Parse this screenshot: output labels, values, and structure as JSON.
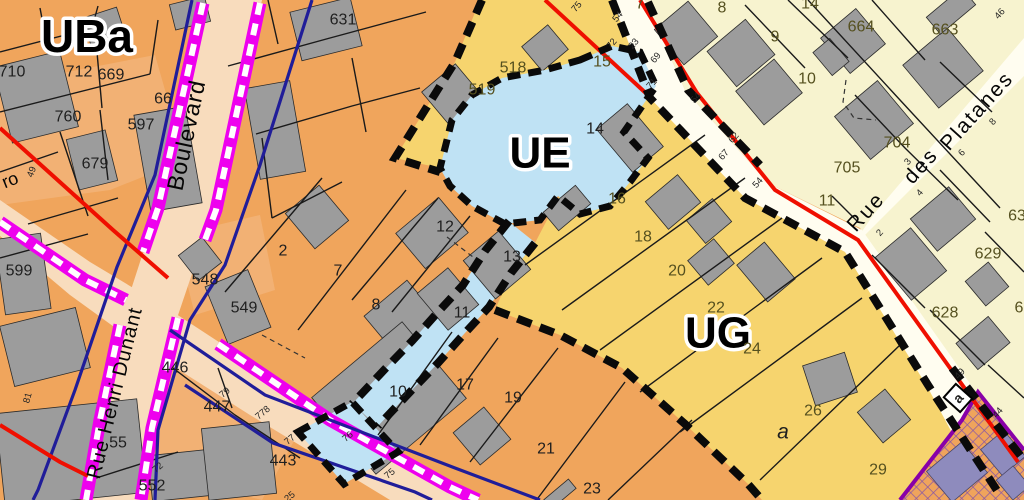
{
  "map": {
    "title": "zoning-plan-extract",
    "zones": {
      "uba": {
        "label": "UBa",
        "color": "#f0a55c"
      },
      "ue": {
        "label": "UE",
        "color": "#bfe2f4"
      },
      "ug": {
        "label": "UG",
        "color": "#f6d46e"
      },
      "cream_zone_color": "#f7f3cf",
      "street_color": "#f8dcbd",
      "white_street_color": "#fffdf0",
      "building_color": "#9c9c9c",
      "hatch_building_color": "#8e8bbd"
    },
    "line_colors": {
      "magenta": "#ee00ee",
      "navy": "#201d99",
      "red": "#ef0f00",
      "purple": "#8800a8",
      "boundary_black": "#0a0a0a",
      "parcel_line": "#1a1a1a"
    },
    "zone_labels": {
      "uba": {
        "text": "UBa"
      },
      "ue": {
        "text": "UE"
      },
      "ug": {
        "text": "UG"
      }
    },
    "street_labels": [
      {
        "t": "Boulevard",
        "x": 186,
        "y": 135,
        "r": -78,
        "s": 23,
        "ls": 1
      },
      {
        "t": "Rue Henri Dunant",
        "x": 115,
        "y": 393,
        "r": -76,
        "s": 20,
        "ls": 1
      },
      {
        "t": "ro",
        "x": 10,
        "y": 180,
        "r": -22,
        "s": 18,
        "ls": 0
      },
      {
        "t": "Rue",
        "x": 866,
        "y": 212,
        "r": -48,
        "s": 21,
        "ls": 2
      },
      {
        "t": "des",
        "x": 921,
        "y": 166,
        "r": -48,
        "s": 21,
        "ls": 2
      },
      {
        "t": "Platanes",
        "x": 977,
        "y": 111,
        "r": -48,
        "s": 21,
        "ls": 2
      }
    ],
    "parcel_labels": [
      {
        "t": "631",
        "x": 343,
        "y": 20
      },
      {
        "t": "710",
        "x": 12,
        "y": 72
      },
      {
        "t": "712",
        "x": 79,
        "y": 72
      },
      {
        "t": "669",
        "x": 111,
        "y": 75
      },
      {
        "t": "66",
        "x": 163,
        "y": 99
      },
      {
        "t": "760",
        "x": 68,
        "y": 117
      },
      {
        "t": "597",
        "x": 141,
        "y": 125
      },
      {
        "t": "679",
        "x": 95,
        "y": 164
      },
      {
        "t": "599",
        "x": 19,
        "y": 271
      },
      {
        "t": "548",
        "x": 205,
        "y": 280
      },
      {
        "t": "549",
        "x": 244,
        "y": 308
      },
      {
        "t": "446",
        "x": 175,
        "y": 368
      },
      {
        "t": "447",
        "x": 217,
        "y": 407
      },
      {
        "t": "443",
        "x": 283,
        "y": 461
      },
      {
        "t": "552",
        "x": 152,
        "y": 486
      },
      {
        "t": "55",
        "x": 118,
        "y": 443
      },
      {
        "t": "2",
        "x": 283,
        "y": 251
      },
      {
        "t": "7",
        "x": 338,
        "y": 271
      },
      {
        "t": "8",
        "x": 376,
        "y": 305
      },
      {
        "t": "12",
        "x": 445,
        "y": 227
      },
      {
        "t": "13",
        "x": 512,
        "y": 257
      },
      {
        "t": "11",
        "x": 462,
        "y": 313
      },
      {
        "t": "10",
        "x": 398,
        "y": 392
      },
      {
        "t": "17",
        "x": 465,
        "y": 385
      },
      {
        "t": "19",
        "x": 513,
        "y": 398
      },
      {
        "t": "21",
        "x": 546,
        "y": 449
      },
      {
        "t": "23",
        "x": 592,
        "y": 489
      },
      {
        "t": "518",
        "x": 513,
        "y": 68,
        "c": "olive"
      },
      {
        "t": "519",
        "x": 482,
        "y": 90,
        "c": "olive"
      },
      {
        "t": "15",
        "x": 602,
        "y": 62,
        "c": "olive"
      },
      {
        "t": "14",
        "x": 595,
        "y": 129
      },
      {
        "t": "16",
        "x": 617,
        "y": 199,
        "c": "olive"
      },
      {
        "t": "18",
        "x": 643,
        "y": 237,
        "c": "olive"
      },
      {
        "t": "20",
        "x": 677,
        "y": 271,
        "c": "olive"
      },
      {
        "t": "22",
        "x": 716,
        "y": 308,
        "c": "olive"
      },
      {
        "t": "24",
        "x": 752,
        "y": 349,
        "c": "olive"
      },
      {
        "t": "26",
        "x": 813,
        "y": 411,
        "c": "olive"
      },
      {
        "t": "29",
        "x": 878,
        "y": 470,
        "c": "olive"
      },
      {
        "t": "a",
        "x": 783,
        "y": 432,
        "c": "italic"
      },
      {
        "t": "7",
        "x": 640,
        "y": 4,
        "c": "olive"
      },
      {
        "t": "8",
        "x": 722,
        "y": 8,
        "c": "olive"
      },
      {
        "t": "9",
        "x": 775,
        "y": 37,
        "c": "olive"
      },
      {
        "t": "10",
        "x": 807,
        "y": 79,
        "c": "olive"
      },
      {
        "t": "14",
        "x": 810,
        "y": 4,
        "c": "olive"
      },
      {
        "t": "664",
        "x": 861,
        "y": 27,
        "c": "olive"
      },
      {
        "t": "663",
        "x": 945,
        "y": 30,
        "c": "olive"
      },
      {
        "t": "704",
        "x": 897,
        "y": 143,
        "c": "olive"
      },
      {
        "t": "705",
        "x": 847,
        "y": 168,
        "c": "olive"
      },
      {
        "t": "11",
        "x": 827,
        "y": 201,
        "c": "olive"
      },
      {
        "t": "629",
        "x": 988,
        "y": 254,
        "c": "olive"
      },
      {
        "t": "628",
        "x": 945,
        "y": 313,
        "c": "olive"
      },
      {
        "t": "63",
        "x": 1017,
        "y": 216,
        "c": "olive"
      },
      {
        "t": "6",
        "x": 1019,
        "y": 308,
        "c": "olive"
      }
    ],
    "tick_labels": [
      {
        "t": "75",
        "x": 577,
        "y": 7,
        "r": -50
      },
      {
        "t": "54",
        "x": 618,
        "y": 17,
        "r": -50
      },
      {
        "t": "72",
        "x": 612,
        "y": 44,
        "r": -50
      },
      {
        "t": "23",
        "x": 634,
        "y": 44,
        "r": -50
      },
      {
        "t": "69",
        "x": 656,
        "y": 58,
        "r": -50
      },
      {
        "t": "71",
        "x": 652,
        "y": 84,
        "r": -48
      },
      {
        "t": "54",
        "x": 696,
        "y": 98,
        "r": -48
      },
      {
        "t": "62",
        "x": 734,
        "y": 138,
        "r": -48
      },
      {
        "t": "67",
        "x": 724,
        "y": 155,
        "r": -48
      },
      {
        "t": "54",
        "x": 758,
        "y": 183,
        "r": -48
      },
      {
        "t": "46",
        "x": 1000,
        "y": 14,
        "r": -48
      },
      {
        "t": "49",
        "x": 960,
        "y": 374,
        "r": -48
      },
      {
        "t": "44",
        "x": 998,
        "y": 413,
        "r": -48
      },
      {
        "t": "79",
        "x": 225,
        "y": 393,
        "r": -40
      },
      {
        "t": "778",
        "x": 263,
        "y": 413,
        "r": -40
      },
      {
        "t": "72",
        "x": 158,
        "y": 468,
        "r": -40
      },
      {
        "t": "77",
        "x": 290,
        "y": 440,
        "r": -40
      },
      {
        "t": "76",
        "x": 348,
        "y": 437,
        "r": -40
      },
      {
        "t": "75",
        "x": 390,
        "y": 474,
        "r": -40
      },
      {
        "t": "25",
        "x": 290,
        "y": 497,
        "r": -40
      },
      {
        "t": "49",
        "x": 32,
        "y": 172,
        "r": -70
      },
      {
        "t": "81",
        "x": 28,
        "y": 398,
        "r": -75
      },
      {
        "t": "3",
        "x": 908,
        "y": 162,
        "r": -48
      },
      {
        "t": "4",
        "x": 920,
        "y": 193,
        "r": -48
      },
      {
        "t": "6",
        "x": 962,
        "y": 153,
        "r": -48
      },
      {
        "t": "8",
        "x": 993,
        "y": 122,
        "r": -48
      },
      {
        "t": "2",
        "x": 880,
        "y": 233,
        "r": -48
      }
    ],
    "boxed_label": {
      "text": "a"
    }
  }
}
